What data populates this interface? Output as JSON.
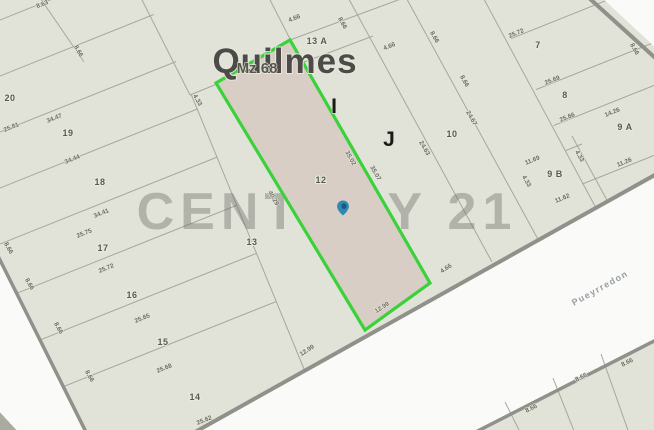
{
  "map": {
    "city_label": "Quilmes",
    "block_label": "Mz 68",
    "street_label": "Pueyrredon",
    "watermark": "CENTURY 21",
    "colors": {
      "block_fill": "#e2e3d8",
      "street_fill": "#fafaf8",
      "highlight_stroke": "#3ad13a",
      "highlight_fill": "#d9cec5",
      "pin_color": "#2e8ab5",
      "line_color": "#a5a89b",
      "street_edge_color": "#8f918a"
    },
    "sector_letters": [
      {
        "t": "I",
        "x": 334,
        "y": 113
      },
      {
        "t": "J",
        "x": 389,
        "y": 146
      }
    ],
    "parcel_numbers": [
      {
        "t": "20",
        "x": 10,
        "y": 101
      },
      {
        "t": "19",
        "x": 68,
        "y": 136
      },
      {
        "t": "18",
        "x": 100,
        "y": 185
      },
      {
        "t": "17",
        "x": 103,
        "y": 251
      },
      {
        "t": "16",
        "x": 132,
        "y": 298
      },
      {
        "t": "15",
        "x": 163,
        "y": 345
      },
      {
        "t": "14",
        "x": 195,
        "y": 400
      },
      {
        "t": "13",
        "x": 252,
        "y": 245
      },
      {
        "t": "13 A",
        "x": 317,
        "y": 44
      },
      {
        "t": "12",
        "x": 321,
        "y": 183
      },
      {
        "t": "10",
        "x": 452,
        "y": 137
      },
      {
        "t": "7",
        "x": 538,
        "y": 48
      },
      {
        "t": "8",
        "x": 565,
        "y": 98
      },
      {
        "t": "9 A",
        "x": 625,
        "y": 130
      },
      {
        "t": "9 B",
        "x": 555,
        "y": 177
      }
    ],
    "dimensions": [
      {
        "t": "8.63",
        "x": 43,
        "y": 6,
        "r": -22
      },
      {
        "t": "8.66",
        "x": 77,
        "y": 52,
        "r": 60
      },
      {
        "t": "25.81",
        "x": 12,
        "y": 129,
        "r": -22
      },
      {
        "t": "34.47",
        "x": 55,
        "y": 120,
        "r": -22
      },
      {
        "t": "34.44",
        "x": 73,
        "y": 161,
        "r": -22
      },
      {
        "t": "34.41",
        "x": 102,
        "y": 215,
        "r": -22
      },
      {
        "t": "25.75",
        "x": 85,
        "y": 235,
        "r": -22
      },
      {
        "t": "25.72",
        "x": 107,
        "y": 270,
        "r": -22
      },
      {
        "t": "25.65",
        "x": 143,
        "y": 320,
        "r": -22
      },
      {
        "t": "25.68",
        "x": 165,
        "y": 370,
        "r": -22
      },
      {
        "t": "25.62",
        "x": 205,
        "y": 422,
        "r": -22
      },
      {
        "t": "8.66",
        "x": 7,
        "y": 249,
        "r": 60
      },
      {
        "t": "8.66",
        "x": 28,
        "y": 285,
        "r": 60
      },
      {
        "t": "8.66",
        "x": 57,
        "y": 329,
        "r": 60
      },
      {
        "t": "8.66",
        "x": 88,
        "y": 377,
        "r": 60
      },
      {
        "t": "4.33",
        "x": 196,
        "y": 101,
        "r": 60
      },
      {
        "t": "40.29",
        "x": 272,
        "y": 199,
        "r": 60
      },
      {
        "t": "35.02",
        "x": 349,
        "y": 159,
        "r": 60
      },
      {
        "t": "35.07",
        "x": 374,
        "y": 174,
        "r": 60
      },
      {
        "t": "12.99",
        "x": 308,
        "y": 352,
        "r": -33
      },
      {
        "t": "12.99",
        "x": 383,
        "y": 309,
        "r": -33
      },
      {
        "t": "4.66",
        "x": 447,
        "y": 270,
        "r": -33
      },
      {
        "t": "4.66",
        "x": 295,
        "y": 20,
        "r": -22
      },
      {
        "t": "8.66",
        "x": 341,
        "y": 24,
        "r": 60
      },
      {
        "t": "4.66",
        "x": 390,
        "y": 48,
        "r": -22
      },
      {
        "t": "8.66",
        "x": 433,
        "y": 38,
        "r": 60
      },
      {
        "t": "25.72",
        "x": 517,
        "y": 35,
        "r": -22
      },
      {
        "t": "8.66",
        "x": 633,
        "y": 50,
        "r": 60
      },
      {
        "t": "8.66",
        "x": 463,
        "y": 82,
        "r": 60
      },
      {
        "t": "25.69",
        "x": 553,
        "y": 82,
        "r": -22
      },
      {
        "t": "24.63",
        "x": 423,
        "y": 149,
        "r": 60
      },
      {
        "t": "24.67",
        "x": 470,
        "y": 119,
        "r": 60
      },
      {
        "t": "25.66",
        "x": 568,
        "y": 119,
        "r": -22
      },
      {
        "t": "14.26",
        "x": 613,
        "y": 114,
        "r": -22
      },
      {
        "t": "11.69",
        "x": 533,
        "y": 162,
        "r": -22
      },
      {
        "t": "4.33",
        "x": 578,
        "y": 157,
        "r": 60
      },
      {
        "t": "4.33",
        "x": 525,
        "y": 182,
        "r": 60
      },
      {
        "t": "11.62",
        "x": 563,
        "y": 200,
        "r": -22
      },
      {
        "t": "11.26",
        "x": 625,
        "y": 164,
        "r": -22
      },
      {
        "t": "8.66",
        "x": 532,
        "y": 410,
        "r": -27
      },
      {
        "t": "8.66",
        "x": 582,
        "y": 379,
        "r": -27
      },
      {
        "t": "8.66",
        "x": 628,
        "y": 364,
        "r": -27
      }
    ],
    "pin": {
      "x": 343,
      "y": 208
    }
  }
}
